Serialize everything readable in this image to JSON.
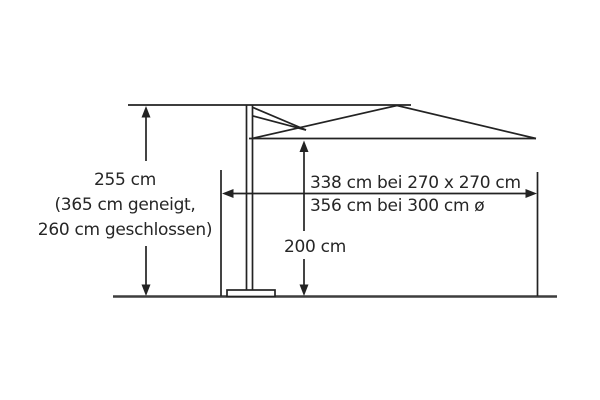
{
  "labels": {
    "height": {
      "line1": "255 cm",
      "line2": "(365 cm geneigt,",
      "line3": "260 cm geschlossen)"
    },
    "span": {
      "line1": "338 cm bei 270 x 270 cm",
      "line2": "356 cm bei 300 cm ø"
    },
    "clearance": "200 cm"
  },
  "colors": {
    "line": "#232323",
    "ground": "#3d3d3d",
    "text": "#262626",
    "background": "#ffffff"
  }
}
